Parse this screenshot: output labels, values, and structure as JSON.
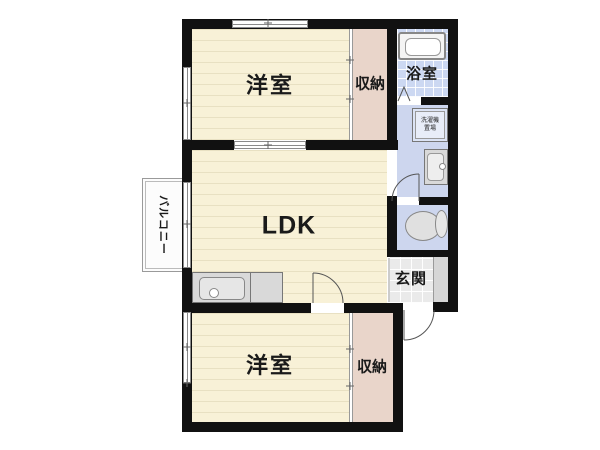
{
  "type": "floor-plan",
  "rooms": {
    "bedroom_top": {
      "label": "洋室"
    },
    "closet_top": {
      "label": "収納"
    },
    "bathroom": {
      "label": "浴室"
    },
    "ldk": {
      "label": "LDK"
    },
    "balcony": {
      "label": "バルコニー"
    },
    "entrance": {
      "label": "玄関"
    },
    "bedroom_bottom": {
      "label": "洋室"
    },
    "closet_bottom": {
      "label": "収納"
    },
    "laundry": {
      "line1": "洗濯機",
      "line2": "置場"
    }
  },
  "fixtures": [
    "bathtub-icon",
    "washing-machine-icon",
    "washbasin-icon",
    "toilet-icon",
    "kitchen-sink-counter-icon"
  ],
  "colors": {
    "wall": "#111111",
    "wood_floor": "#f8f1d7",
    "closet": "#e9d5ca",
    "wet_area": "#cdd6ee",
    "bath_tile": "#ccd8f2",
    "entrance_tile": "#eaeaea",
    "symbol_gray": "#8a8a8a"
  }
}
